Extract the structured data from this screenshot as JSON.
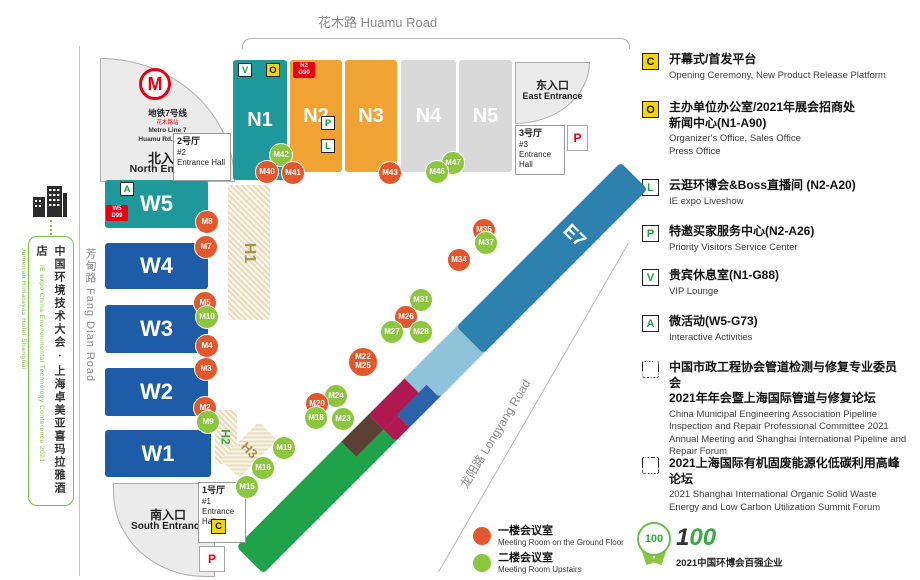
{
  "roads": {
    "huamu": "花木路 Huamu Road",
    "fangdian": "芳甸路 Fang Dian Road",
    "longyang": "龙阳路 Longyang Road"
  },
  "sidebar": {
    "title_zh": "中国环境技术大会 · 上海卓美亚喜玛拉雅酒店",
    "title_en": "IE expo China Environmental Technology Conference 2021",
    "hotel_en": "Jumeirah Himalayas Hotel Shanghai"
  },
  "metro": {
    "line_zh": "地铁7号线",
    "station_zh": "花木路站",
    "line_en": "Metro Line 7",
    "station_en": "Huamu Rd. Station"
  },
  "entrances": {
    "north_zh": "北入口",
    "north_en": "North Entrance",
    "east_zh": "东入口",
    "east_en": "East Entrance",
    "south_zh": "南入口",
    "south_en": "South Entrance"
  },
  "entrance_halls": {
    "no1_zh": "1号厅",
    "no1_num": "#1",
    "no1_en": "Entrance Hall",
    "no2_zh": "2号厅",
    "no2_num": "#2",
    "no2_en": "Entrance Hall",
    "no3_zh": "3号厅",
    "no3_num": "#3",
    "no3_en": "Entrance Hall"
  },
  "halls": {
    "n1": "N1",
    "n2": "N2",
    "n3": "N3",
    "n4": "N4",
    "n5": "N5",
    "w1": "W1",
    "w2": "W2",
    "w3": "W3",
    "w4": "W4",
    "w5": "W5",
    "e1": "E1",
    "e2": "E2",
    "e3": "E3",
    "e4": "E4",
    "e5": "E5",
    "e6": "E6",
    "e7": "E7",
    "h1": "H1",
    "h2": "H2",
    "h3": "H3"
  },
  "map_badges": {
    "v": "V",
    "o": "O",
    "p_service": "P",
    "l": "L",
    "a": "A",
    "c": "C",
    "parking": "P",
    "n2g90_line1": "N2",
    "n2g90_line2": "G90",
    "w5d99_line1": "W5",
    "w5d99_line2": "D99"
  },
  "markers": {
    "m2": "M2",
    "m3": "M3",
    "m4": "M4",
    "m5": "M5",
    "m7": "M7",
    "m8": "M8",
    "m9": "M9",
    "m10": "M10",
    "m15": "M15",
    "m16": "M16",
    "m18": "M18",
    "m19": "M19",
    "m20": "M20",
    "m22": "M22",
    "m23": "M23",
    "m24": "M24",
    "m25": "M25",
    "m26": "M26",
    "m27": "M27",
    "m28": "M28",
    "m31": "M31",
    "m34": "M34",
    "m35": "M35",
    "m37": "M37",
    "m40": "M40",
    "m41": "M41",
    "m42": "M42",
    "m43": "M43",
    "m46": "M46",
    "m47": "M47"
  },
  "legend": {
    "c_zh": "开幕式/首发平台",
    "c_en": "Opening Ceremony, New Product Release Platform",
    "o_zh1": "主办单位办公室/2021年展会招商处",
    "o_zh2": "新闻中心(N1-A90)",
    "o_en1": "Organizer's Office, Sales Office",
    "o_en2": "Press Office",
    "l_zh": "云逛环博会&Boss直播间 (N2-A20)",
    "l_en": "IE expo Liveshow",
    "p_zh": "特邀买家服务中心(N2-A26)",
    "p_en": "Priority Visitors Service Center",
    "v_zh": "贵宾休息室(N1-G88)",
    "v_en": "VIP Lounge",
    "a_zh": "微活动(W5-G73)",
    "a_en": "Interactive Activities",
    "w5d99_zh1": "中国市政工程协会管道检测与修复专业委员会",
    "w5d99_zh2": "2021年年会暨上海国际管道与修复论坛",
    "w5d99_en": "China Municipal Engineering Association Pipeline Inspection and Repair Professional Committee 2021 Annual Meeting and Shanghai International Pipeline and Repair Forum",
    "n2g90_zh": "2021上海国际有机固废能源化低碳利用高峰论坛",
    "n2g90_en": "2021 Shanghai International Organic Solid Waste Energy and Low Carbon Utilization Summit Forum"
  },
  "meeting_legend": {
    "ground_zh": "一楼会议室",
    "ground_en": "Meeting Room on the Ground Floor",
    "upstairs_zh": "二楼会议室",
    "upstairs_en": "Meeting Room Upstairs"
  },
  "footer": {
    "medal_number": "100",
    "logo_digit": "1",
    "logo_zeros": "00",
    "award_zh": "2021中国环博会百强企业"
  },
  "colors": {
    "teal_hall": "#1E989B",
    "orange_hall": "#F0A233",
    "gray_hall": "#D9D9D9",
    "blue_hall": "#1E5CA8",
    "green_hall": "#1FA24A",
    "light_blue_hall": "#8FC3D9",
    "steel_blue_hall": "#2E80AE",
    "crimson_segment": "#B0194F",
    "brown_segment": "#5C4033",
    "orange_segment": "#E8661D",
    "dark_blue_segment": "#2B63A9",
    "marker_ground_floor": "#E2572B",
    "marker_upstairs": "#8CC63F",
    "badge_yellow": "#F7D500",
    "badge_red": "#E60012",
    "badge_letter_green": "#1E9E46",
    "sidebar_green": "#7AC143"
  }
}
